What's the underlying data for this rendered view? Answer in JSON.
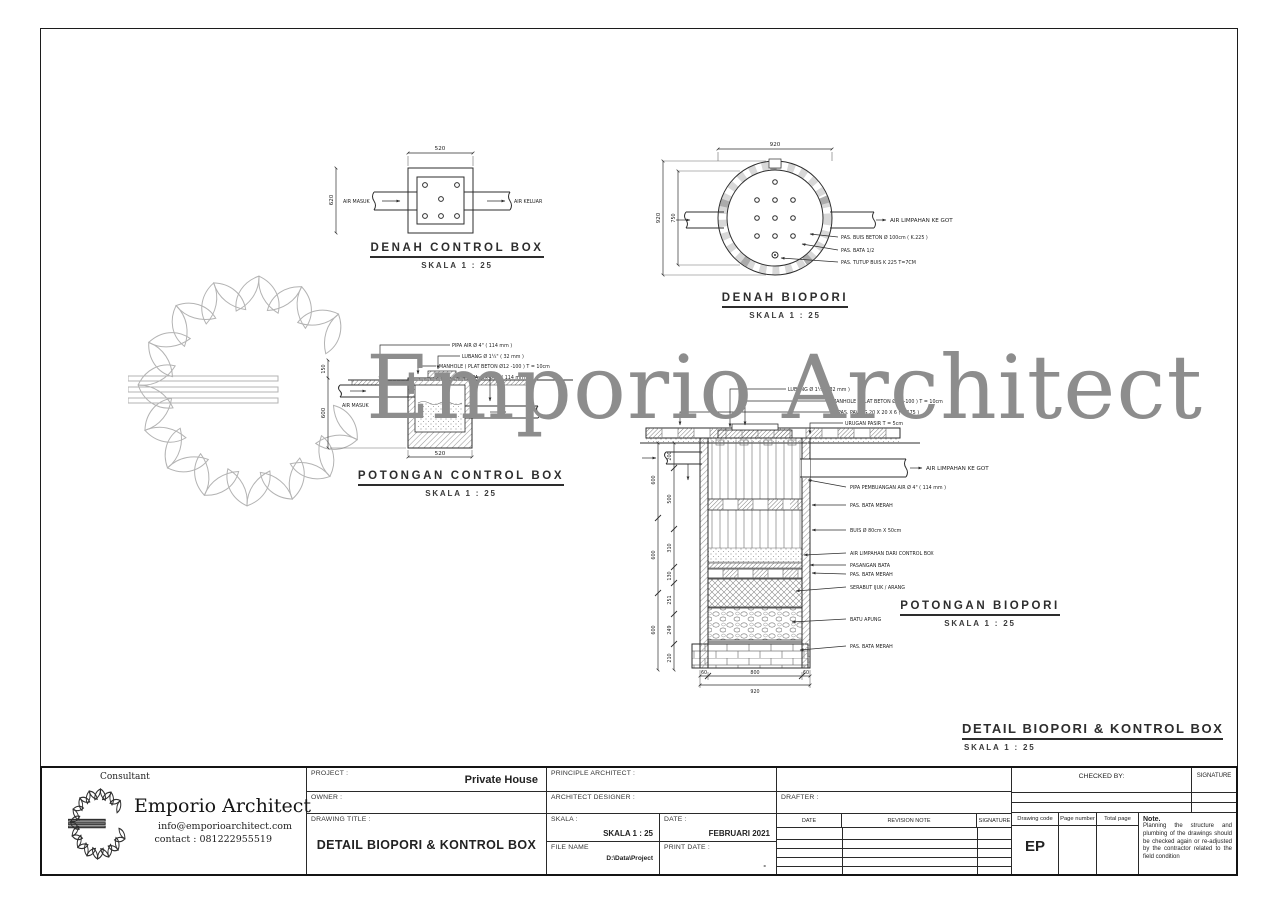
{
  "watermark": {
    "text": "Emporio Architect"
  },
  "panels": {
    "denah_control_box": {
      "title": "DENAH CONTROL BOX",
      "scale": "SKALA 1 : 25",
      "dim_top": "520",
      "dim_left": "620",
      "label_in": "AIR MASUK",
      "label_out": "AIR KELUAR"
    },
    "denah_biopori": {
      "title": "DENAH BIOPORI",
      "scale": "SKALA 1 : 25",
      "dim_top": "920",
      "dim_left_outer": "920",
      "dim_left_inner": "750",
      "label_out": "AIR LIMPAHAN KE GOT",
      "labels_right": [
        "PAS. BUIS BETON Ø 100cm ( K.225 )",
        "PAS. BATA 1/2",
        "PAS. TUTUP BUIS K 225 T=7CM"
      ]
    },
    "potongan_control_box": {
      "title": "POTONGAN CONTROL BOX",
      "scale": "SKALA 1 : 25",
      "labels_top": [
        "PIPA AIR Ø 4\" ( 114 mm )",
        "LUBANG Ø 1¼\" ( 32 mm )",
        "MANHOLE ( PLAT BETON Ø12 -100 ) T = 10cm",
        "PIPA AIR Ø 4\" ( 114 mm )"
      ],
      "label_in": "AIR MASUK",
      "dim_bottom": "520",
      "dim_left_top": "150",
      "dim_left": "600"
    },
    "potongan_biopori": {
      "title": "POTONGAN BIOPORI",
      "scale": "SKALA 1 : 25",
      "labels_top": [
        "LUBANG Ø 1¼\" ( 32 mm )",
        "MANHOLE ( PLAT BETON Ø12 -100 ) T = 10cm",
        "PAS. PAVING 20 X 20 X 6 ( K.175 )",
        "URUGAN PASIR T = 5cm"
      ],
      "label_out": "AIR LIMPAHAN KE GOT",
      "labels_right": [
        "PIPA PEMBUANGAN AIR Ø 4\" ( 114 mm )",
        "PAS. BATA MERAH",
        "BUIS Ø 80cm X 50cm",
        "AIR LIMPAHAN DARI CONTROL BOX",
        "PASANGAN BATA",
        "PAS. BATA MERAH",
        "SERABUT IJUK / ARANG",
        "BATU APUNG",
        "PAS. BATA MERAH"
      ],
      "dims_left_outer": [
        "600",
        "600",
        "600"
      ],
      "dims_left_inner": [
        "200",
        "500",
        "310",
        "130",
        "251",
        "249",
        "210"
      ],
      "dims_bottom": [
        "60",
        "800",
        "60"
      ],
      "dim_bottom_total": "920"
    },
    "sheet_title": {
      "title": "DETAIL BIOPORI & KONTROL BOX",
      "scale": "SKALA 1 : 25"
    }
  },
  "titleblock": {
    "consultant": {
      "heading": "Consultant",
      "name": "Emporio Architect",
      "email": "info@emporioarchitect.com",
      "contact": "contact : 081222955519"
    },
    "project_label": "PROJECT :",
    "project_value": "Private House",
    "owner_label": "OWNER :",
    "drawing_title_label": "DRAWING TITLE :",
    "drawing_title_value": "DETAIL BIOPORI & KONTROL BOX",
    "principle_architect_label": "PRINCIPLE ARCHITECT :",
    "architect_designer_label": "ARCHITECT DESIGNER :",
    "drafter_label": "DRAFTER :",
    "skala_label": "SKALA :",
    "skala_value": "SKALA 1 : 25",
    "date_label": "DATE :",
    "date_value": "FEBRUARI 2021",
    "file_name_label": "FILE NAME",
    "file_name_value": "D:\\Data\\Project",
    "print_date_label": "PRINT DATE :",
    "print_date_value": "-",
    "revision": {
      "date": "DATE",
      "note": "REVISION NOTE",
      "signature": "SIGNATURE"
    },
    "checked_by_label": "CHECKED BY:",
    "signature_label": "SIGNATURE",
    "drawing_code_label": "Drawing code",
    "page_number_label": "Page number",
    "total_page_label": "Total page",
    "drawing_code_value": "EP",
    "note_title": "Note.",
    "note_text": "Planning the structure and plumbing of the drawings should be checked again or re-adjusted by the contractor related to the field condition"
  }
}
